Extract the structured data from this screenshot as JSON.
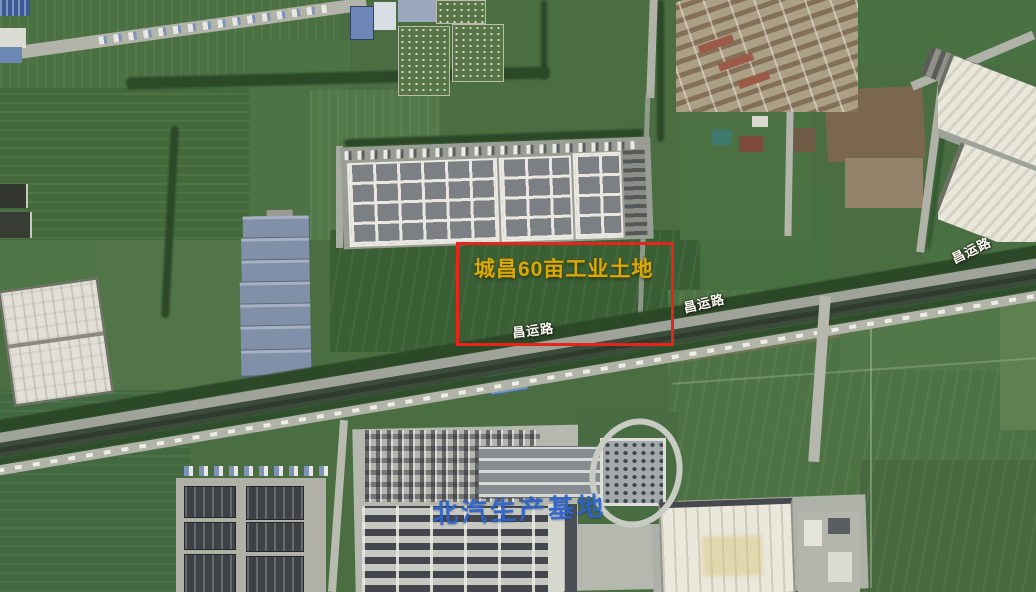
{
  "map": {
    "kind": "satellite-map",
    "highlight_parcel": {
      "label": "城昌60亩工业土地",
      "outline_color": "#e8231a",
      "label_color": "#d4ab07"
    },
    "road_labels": [
      {
        "text": "昌运路"
      },
      {
        "text": "昌运路"
      },
      {
        "text": "昌运路"
      }
    ],
    "facility_labels": [
      {
        "text": "北汽生产基地",
        "label_color": "#2e63c9"
      }
    ]
  }
}
